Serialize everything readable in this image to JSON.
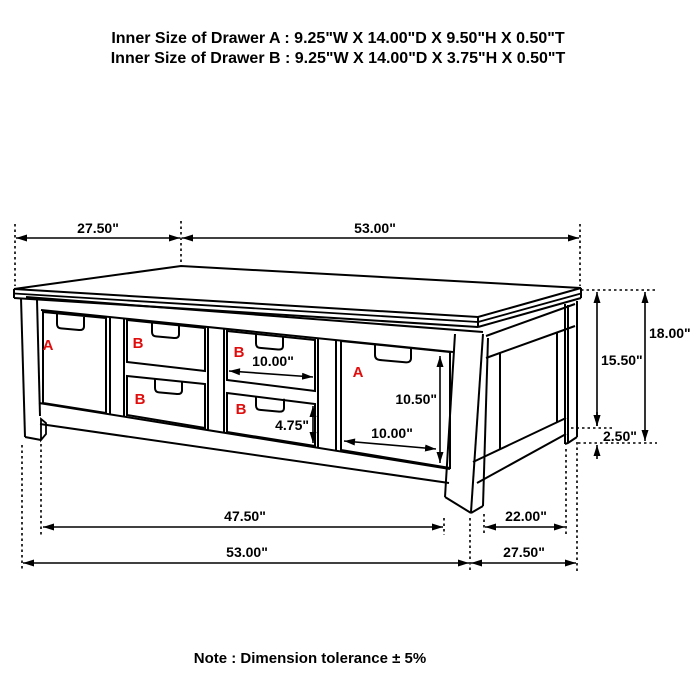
{
  "header": {
    "line_a": "Inner Size of Drawer A : 9.25\"W X 14.00\"D X 9.50\"H X 0.50\"T",
    "line_b": "Inner Size of Drawer B : 9.25\"W X 14.00\"D X 3.75\"H X 0.50\"T"
  },
  "footer": {
    "note": "Note : Dimension tolerance ± 5%"
  },
  "drawer_labels": {
    "left_a": "A",
    "mid_top_b": "B",
    "right_top_b": "B",
    "mid_bottom_b": "B",
    "right_bottom_b": "B",
    "front_a": "A"
  },
  "dimensions": {
    "top_depth": "27.50\"",
    "top_width": "53.00\"",
    "overall_height": "18.00\"",
    "body_height": "15.50\"",
    "leg_clearance": "2.50\"",
    "drawer_b_opening_width": "10.00\"",
    "drawer_b_opening_height": "4.75\"",
    "drawer_a_opening_height": "10.50\"",
    "drawer_a_opening_width": "10.00\"",
    "front_inner_width": "47.50\"",
    "side_inner_depth": "22.00\"",
    "front_overall_width": "53.00\"",
    "side_overall_depth": "27.50\""
  },
  "colors": {
    "line": "#000000",
    "label_red": "#e00d0d"
  }
}
